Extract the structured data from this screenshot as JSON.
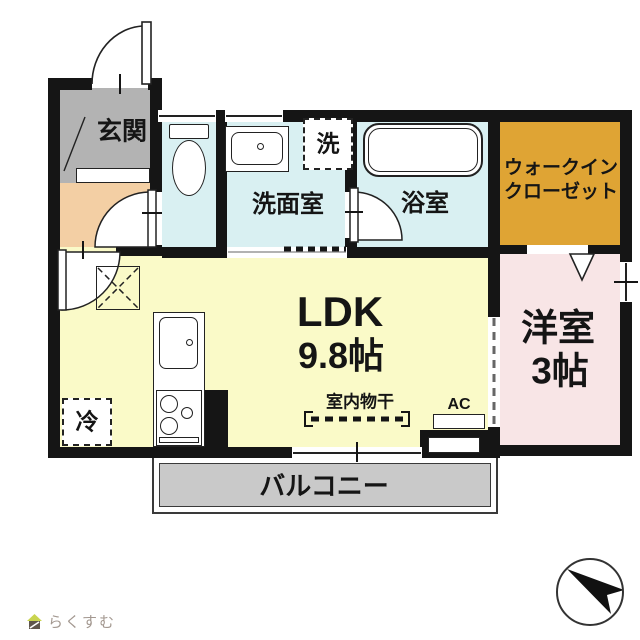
{
  "plan": {
    "labels": {
      "genkan": "玄関",
      "washroom": "洗面室",
      "bathroom": "浴室",
      "wic_line1": "ウォークイン",
      "wic_line2": "クローゼット",
      "ldk": "LDK",
      "ldk_size": "9.8帖",
      "western": "洋室",
      "western_size": "3帖",
      "balcony": "バルコニー",
      "laundry": "洗",
      "fridge": "冷",
      "indoor_drying": "室内物干",
      "ac": "AC"
    },
    "colors": {
      "wall": "#151515",
      "genkan": "#b3b3b3",
      "hall": "#f3cfa4",
      "wet_rooms": "#d9f0f2",
      "walk_in_closet": "#dfa434",
      "ldk": "#fafac8",
      "western_room": "#f8e5e6",
      "balcony": "#c9c9c9"
    }
  },
  "branding": {
    "logo_text": "らくすむ"
  }
}
